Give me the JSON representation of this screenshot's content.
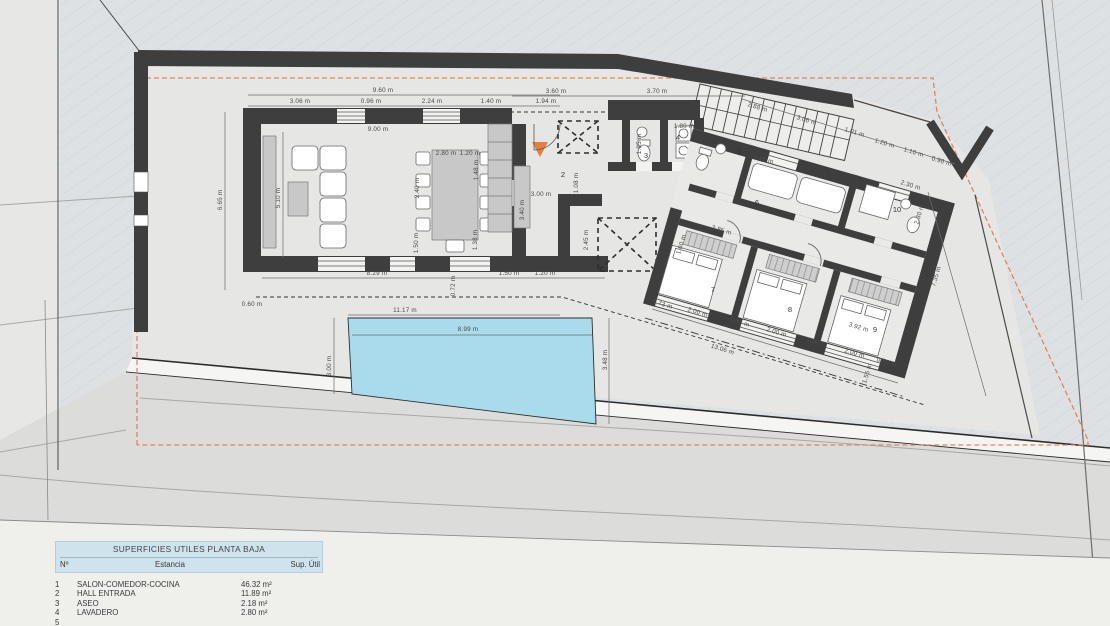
{
  "colors": {
    "pool": "#a9dbec",
    "accent_orange": "#e2813d",
    "setback_dash": "#e0855a",
    "wall": "#3e3e3e",
    "table_header_bg": "#cfe3ed"
  },
  "table": {
    "title": "SUPERFICIES UTILES PLANTA BAJA",
    "columns": [
      "Nº",
      "Estancia",
      "Sup. Útil"
    ],
    "rows": [
      [
        "1",
        "SALON-COMEDOR-COCINA",
        "46.32 m²"
      ],
      [
        "2",
        "HALL ENTRADA",
        "11.89 m²"
      ],
      [
        "3",
        "ASEO",
        "2.18 m²"
      ],
      [
        "4",
        "LAVADERO",
        "2.80 m²"
      ],
      [
        "5",
        "",
        ""
      ]
    ]
  },
  "plan": {
    "entry_marker": "entry-arrow",
    "room_numbers": [
      {
        "n": "2",
        "x": 563,
        "y": 177
      },
      {
        "n": "3",
        "x": 646,
        "y": 158
      },
      {
        "n": "4",
        "x": 678,
        "y": 140
      },
      {
        "n": "5",
        "x": 739,
        "y": 154
      },
      {
        "n": "6",
        "x": 757,
        "y": 205
      },
      {
        "n": "7",
        "x": 713,
        "y": 292
      },
      {
        "n": "8",
        "x": 790,
        "y": 312
      },
      {
        "n": "9",
        "x": 875,
        "y": 332
      },
      {
        "n": "10",
        "x": 897,
        "y": 212
      }
    ],
    "dimensions": [
      {
        "t": "9.60 m",
        "x": 383,
        "y": 92
      },
      {
        "t": "3.06 m",
        "x": 300,
        "y": 103
      },
      {
        "t": "0.96 m",
        "x": 371,
        "y": 103
      },
      {
        "t": "2.24 m",
        "x": 432,
        "y": 103
      },
      {
        "t": "1.40 m",
        "x": 491,
        "y": 103
      },
      {
        "t": "1.94 m",
        "x": 546,
        "y": 103
      },
      {
        "t": "3.60 m",
        "x": 556,
        "y": 93
      },
      {
        "t": "3.70 m",
        "x": 657,
        "y": 93
      },
      {
        "t": "9.00 m",
        "x": 378,
        "y": 131
      },
      {
        "t": "6.65 m",
        "x": 222,
        "y": 200,
        "r": -90
      },
      {
        "t": "5.10 m",
        "x": 280,
        "y": 198,
        "r": -90
      },
      {
        "t": "2.40 m",
        "x": 419,
        "y": 188,
        "r": -90
      },
      {
        "t": "1.50 m",
        "x": 418,
        "y": 243,
        "r": -90
      },
      {
        "t": "1.48 m",
        "x": 478,
        "y": 170,
        "r": -90
      },
      {
        "t": "1.38 m",
        "x": 477,
        "y": 240,
        "r": -90
      },
      {
        "t": "2.80 m",
        "x": 446,
        "y": 155
      },
      {
        "t": "1.20 m",
        "x": 470,
        "y": 155
      },
      {
        "t": "3.40 m",
        "x": 524,
        "y": 210,
        "r": -90
      },
      {
        "t": "3.00 m",
        "x": 541,
        "y": 196
      },
      {
        "t": "1.08 m",
        "x": 578,
        "y": 183,
        "r": -90
      },
      {
        "t": "2.45 m",
        "x": 588,
        "y": 240,
        "r": -90
      },
      {
        "t": "8.29 m",
        "x": 377,
        "y": 275
      },
      {
        "t": "1.50 m",
        "x": 509,
        "y": 275
      },
      {
        "t": "1.20 m",
        "x": 545,
        "y": 275
      },
      {
        "t": "0.60 m",
        "x": 252,
        "y": 306
      },
      {
        "t": "0.72 m",
        "x": 455,
        "y": 286,
        "r": -90
      },
      {
        "t": "11.17 m",
        "x": 405,
        "y": 312
      },
      {
        "t": "8.99 m",
        "x": 468,
        "y": 331
      },
      {
        "t": "3.00 m",
        "x": 331,
        "y": 366,
        "r": -90
      },
      {
        "t": "3.48 m",
        "x": 607,
        "y": 360,
        "r": -90
      },
      {
        "t": "1.80 m",
        "x": 684,
        "y": 128
      },
      {
        "t": "1.95 m",
        "x": 641,
        "y": 144,
        "r": -90
      },
      {
        "t": "2.96 m",
        "x": 763,
        "y": 161,
        "r": 17
      },
      {
        "t": "2.85 m",
        "x": 721,
        "y": 232,
        "r": 17
      },
      {
        "t": "1.60 m",
        "x": 683,
        "y": 245,
        "r": -73
      },
      {
        "t": "2.88 m",
        "x": 757,
        "y": 109,
        "r": 17
      },
      {
        "t": "3.06 m",
        "x": 806,
        "y": 122,
        "r": 17
      },
      {
        "t": "1.01 m",
        "x": 854,
        "y": 134,
        "r": 17
      },
      {
        "t": "1.20 m",
        "x": 884,
        "y": 145,
        "r": 17
      },
      {
        "t": "1.10 m",
        "x": 913,
        "y": 154,
        "r": 17
      },
      {
        "t": "0.90 m",
        "x": 941,
        "y": 163,
        "r": 17
      },
      {
        "t": "2.30 m",
        "x": 910,
        "y": 187,
        "r": 17
      },
      {
        "t": "2.30 m",
        "x": 921,
        "y": 215,
        "r": -73
      },
      {
        "t": "7.35 m",
        "x": 938,
        "y": 277,
        "r": -73
      },
      {
        "t": "0.73 m",
        "x": 662,
        "y": 306,
        "r": 17
      },
      {
        "t": "2.00 m",
        "x": 697,
        "y": 314,
        "r": 17
      },
      {
        "t": "0.96 m",
        "x": 739,
        "y": 324,
        "r": 17
      },
      {
        "t": "2.00 m",
        "x": 776,
        "y": 334,
        "r": 17
      },
      {
        "t": "1.02 m",
        "x": 816,
        "y": 344,
        "r": 17
      },
      {
        "t": "2.00 m",
        "x": 854,
        "y": 355,
        "r": 17
      },
      {
        "t": "0.50 m",
        "x": 886,
        "y": 364,
        "r": 17
      },
      {
        "t": "3.92 m",
        "x": 858,
        "y": 329,
        "r": 17
      },
      {
        "t": "1.55 m",
        "x": 869,
        "y": 374,
        "r": -73
      },
      {
        "t": "13.06 m",
        "x": 722,
        "y": 351,
        "r": 17
      }
    ]
  }
}
